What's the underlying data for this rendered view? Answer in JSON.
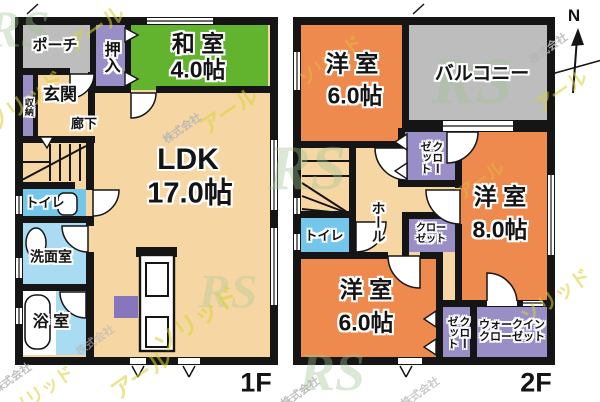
{
  "compass": {
    "label": "N"
  },
  "floor1": {
    "label": "1F",
    "porch": "ポーチ",
    "oshiire": "押入",
    "washitsu": "和 室",
    "washitsu_size": "4.0帖",
    "genkan": "玄関",
    "shunou": "収納",
    "rouka": "廊下",
    "ldk": "LDK",
    "ldk_size": "17.0帖",
    "toilet": "トイレ",
    "senmen": "洗面室",
    "bath": "浴 室"
  },
  "floor2": {
    "label": "2F",
    "west_a": "洋 室",
    "west_a_size": "6.0帖",
    "balcony": "バルコニー",
    "closet_top": "クローゼット",
    "hall": "ホール",
    "toilet": "トイレ",
    "closet_mid": "クローゼット",
    "west_b": "洋 室",
    "west_b_size": "8.0帖",
    "west_c": "洋 室",
    "west_c_size": "6.0帖",
    "closet_bottom": "クローゼット",
    "walkin": "ウォークインクローゼット"
  },
  "watermark": {
    "company": "株式会社",
    "brand_r": "アール",
    "brand_s": "ソリッド",
    "logo": "RS"
  },
  "colors": {
    "wall": "#151515",
    "floor_cream": "#f6d7a4",
    "tatami_green": "#62b32e",
    "room_orange": "#ee8a4e",
    "closet_purple": "#998fc6",
    "accent_purple": "#8677bd",
    "porch_gray": "#bdbdbd",
    "toilet_blue": "#74c7eb",
    "wash_blue": "#a9dcf2",
    "watermark_yellow": "#d8d335",
    "watermark_gray": "#b5b5b5",
    "logo_green": "#9fc493"
  }
}
